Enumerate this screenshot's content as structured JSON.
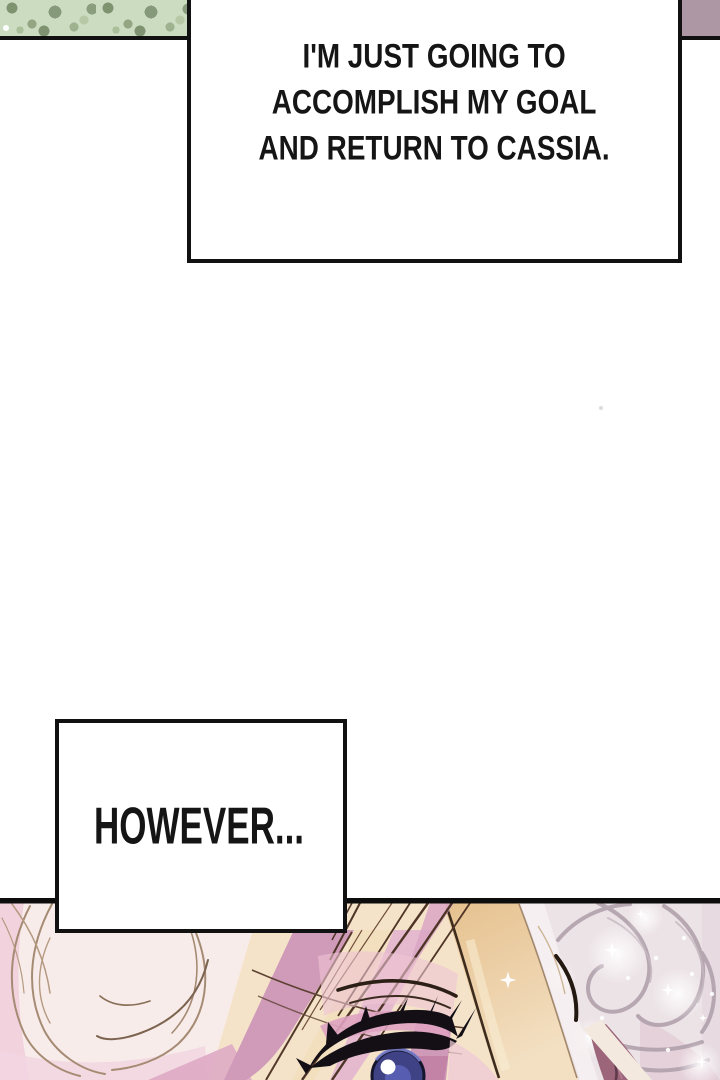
{
  "page": {
    "background": "#ffffff",
    "panel_border_color": "#111111"
  },
  "captions": [
    {
      "lines": [
        "I'M JUST GOING TO",
        "ACCOMPLISH MY GOAL",
        "AND RETURN TO CASSIA."
      ],
      "full_text": "I'M JUST GOING TO ACCOMPLISH MY GOAL AND RETURN TO CASSIA."
    },
    {
      "lines": [
        "HOWEVER..."
      ],
      "full_text": "HOWEVER..."
    }
  ],
  "fragments": {
    "top_left": {
      "kind": "foliage",
      "base_color": "#cbdcc1",
      "blob_color": "#86997a"
    },
    "top_right": {
      "kind": "flat fill",
      "color": "#ae97a4"
    }
  },
  "artwork": {
    "alt": "close-up of blonde character's eye beside sparkling silver hair",
    "colors": {
      "cream_hair": "#f5e3c9",
      "pale_hair": "#f8ecea",
      "pink_hair": "#d09ab9",
      "gold_lock": "#e6c18f",
      "outline_brown": "#a68b74",
      "eye_iris": "#3f4284",
      "lash_black": "#130f15",
      "silver_hair": "#ece3e6",
      "silver_outline": "#b2a2ad",
      "ear_mauve": "#9c6579"
    }
  }
}
